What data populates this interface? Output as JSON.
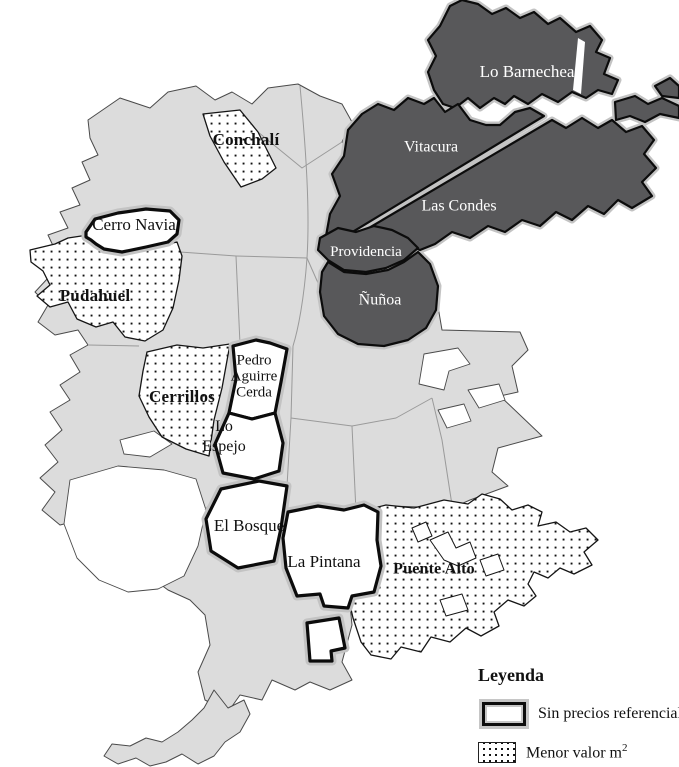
{
  "figure": {
    "type": "comuna-map",
    "city": "Santiago"
  },
  "colors": {
    "background": "#ffffff",
    "base_fill": "#dcdcdc",
    "dark_fill": "#58585a",
    "border_halo": "#c3c3c3",
    "border_black": "#0c0c0c",
    "dot_color": "#111111"
  },
  "regions": {
    "lo_barnechea": {
      "label": "Lo Barnechea",
      "category": "dark"
    },
    "vitacura": {
      "label": "Vitacura",
      "category": "dark"
    },
    "las_condes": {
      "label": "Las Condes",
      "category": "dark"
    },
    "providencia": {
      "label": "Providencia",
      "category": "dark"
    },
    "nunoa": {
      "label": "Ñuñoa",
      "category": "dark"
    },
    "conchali": {
      "label": "Conchalí",
      "category": "dotted"
    },
    "pudahuel": {
      "label": "Pudahuel",
      "category": "dotted"
    },
    "cerrillos": {
      "label": "Cerrillos",
      "category": "dotted"
    },
    "puente_alto": {
      "label": "Puente Alto",
      "category": "dotted"
    },
    "cerro_navia": {
      "label": "Cerro Navia",
      "category": "outlined"
    },
    "pedro_aguirre_cerda": {
      "label": "Pedro Aguirre Cerda",
      "lines": [
        "Pedro",
        "Aguirre",
        "Cerda"
      ],
      "category": "outlined"
    },
    "lo_espejo": {
      "label": "Lo Espejo",
      "lines": [
        "Lo",
        "Espejo"
      ],
      "category": "outlined"
    },
    "el_bosque": {
      "label": "El Bosque",
      "category": "outlined"
    },
    "la_pintana": {
      "label": "La Pintana",
      "category": "outlined"
    }
  },
  "legend": {
    "title": "Leyenda",
    "items": [
      {
        "swatch": "outlined-box",
        "label": "Sin precios referencial"
      },
      {
        "swatch": "dotted-box",
        "label": "Menor valor m",
        "sup": "2"
      }
    ]
  }
}
